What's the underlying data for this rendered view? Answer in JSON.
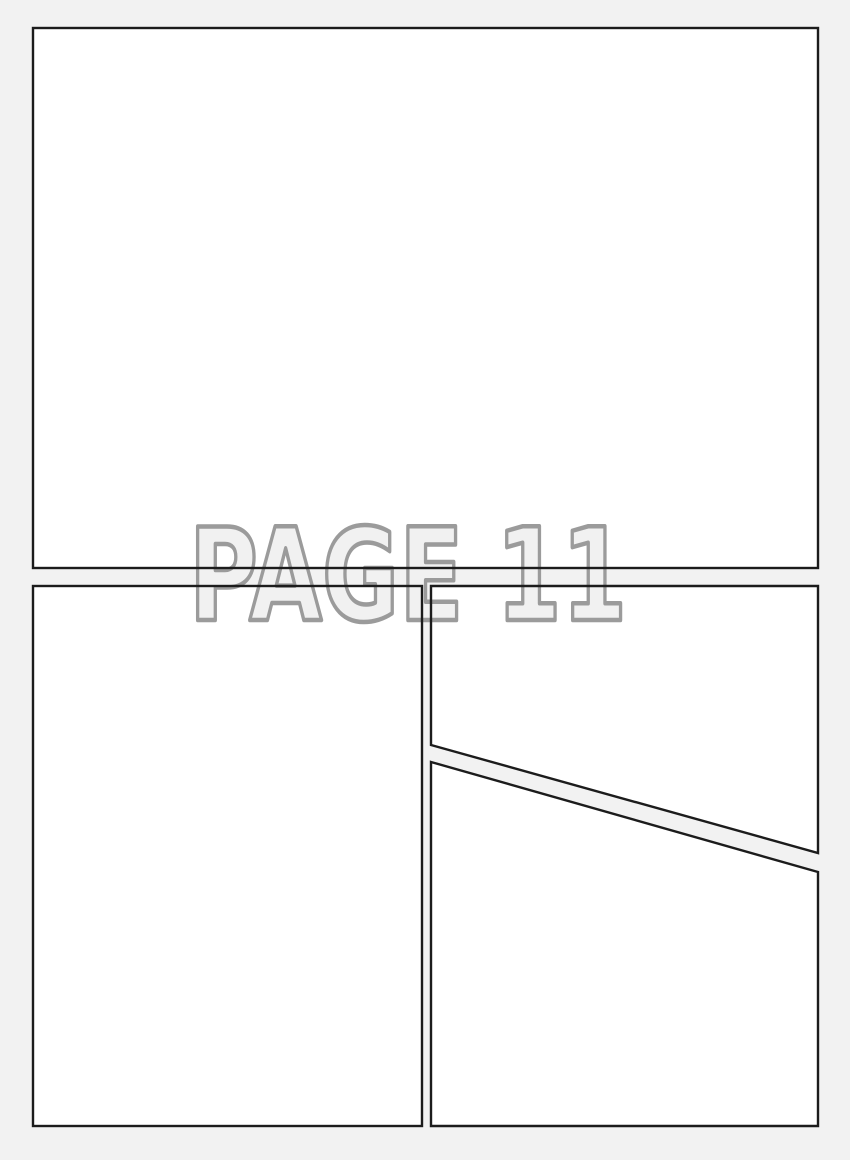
{
  "page": {
    "label": "PAGE 11",
    "description": "Blank comic book page template with three panel areas"
  },
  "colors": {
    "background": "#f2f2f2",
    "panel_fill": "#ffffff",
    "panel_border": "#1c1c1c",
    "label_fill": "#f1f1f1",
    "label_outline": "#9b9b9b"
  },
  "panels": [
    {
      "name": "top-panel"
    },
    {
      "name": "bottom-left-panel"
    },
    {
      "name": "bottom-right-upper-panel"
    },
    {
      "name": "bottom-right-lower-panel"
    }
  ]
}
